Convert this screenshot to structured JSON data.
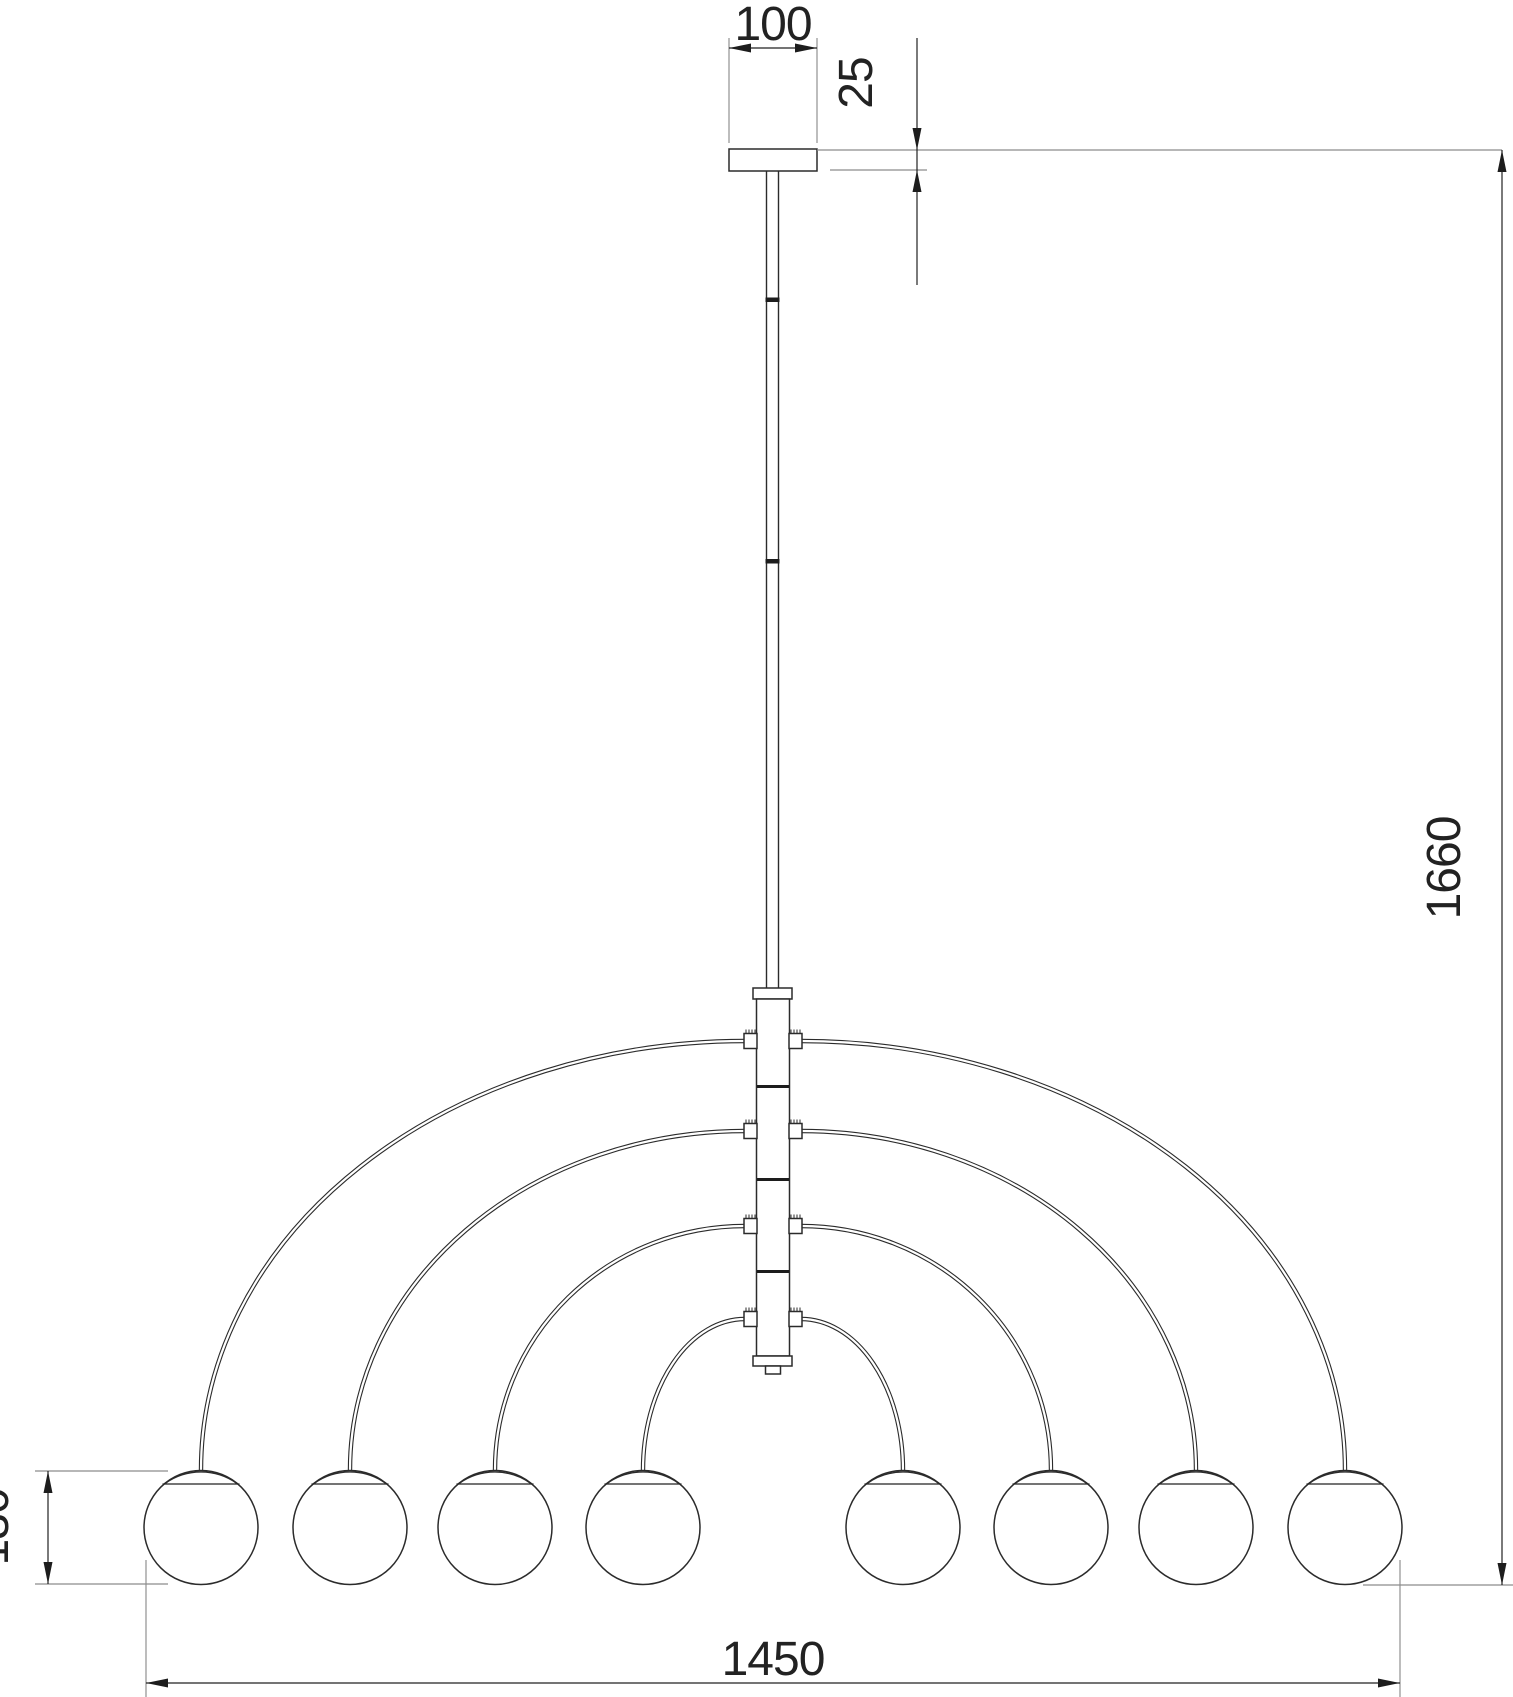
{
  "drawing": {
    "kind": "chandelier-dimension-drawing",
    "dimensions": {
      "canopy_width": "100",
      "canopy_thickness": "25",
      "overall_height": "1660",
      "globe_diameter": "130",
      "overall_width": "1450"
    },
    "colors": {
      "line": "#2b2b2b",
      "extension_line": "#8c8c8c",
      "text": "#222222",
      "background": "#ffffff"
    }
  }
}
